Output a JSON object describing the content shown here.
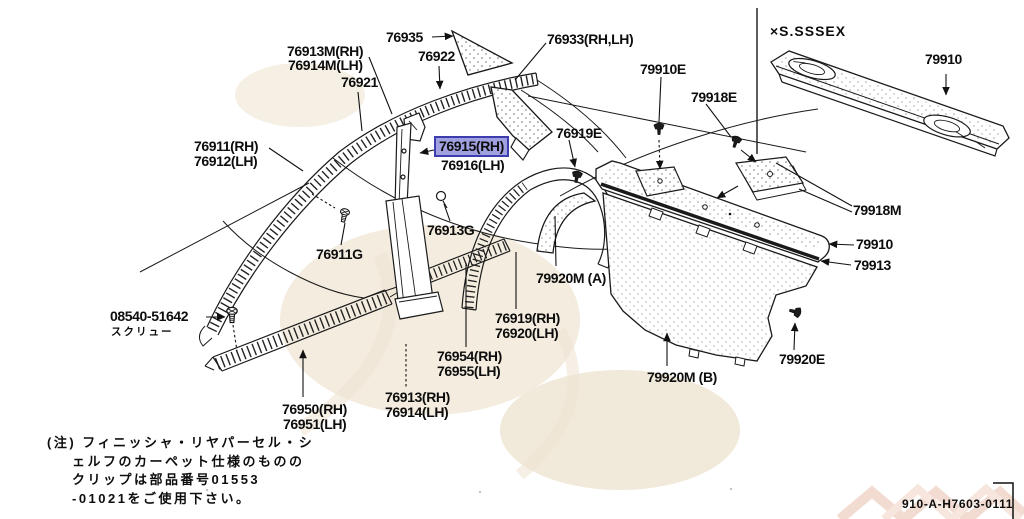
{
  "diagram": {
    "doc_number": "910-A-H7603-0111",
    "inset": {
      "variant": "×S.SSSEX",
      "part": "79910"
    },
    "note": {
      "lines": [
        "(注) フィニッシャ・リヤパーセル・シ",
        "ェルフのカーペット仕様のものの",
        "クリップは部品番号01553",
        "-01021をご使用下さい。"
      ]
    },
    "labels": {
      "l76935": "76935",
      "l76913M_rh": "76913M(RH)",
      "l76914M_lh": "76914M(LH)",
      "l76921": "76921",
      "l76922": "76922",
      "l76933": "76933(RH,LH)",
      "l79910E": "79910E",
      "l79918E": "79918E",
      "l76919E": "76919E",
      "l76911_rh": "76911(RH)",
      "l76912_lh": "76912(LH)",
      "l76915_rh": "76915(RH)",
      "l76916_lh": "76916(LH)",
      "l79918M": "79918M",
      "l79910": "79910",
      "l79913": "79913",
      "l76913G": "76913G",
      "l76911G": "76911G",
      "l79920MA": "79920M (A)",
      "l08540": "08540-51642",
      "l08540_sub": "スクリュー",
      "l76919_rh": "76919(RH)",
      "l76920_lh": "76920(LH)",
      "l76954_rh": "76954(RH)",
      "l76955_lh": "76955(LH)",
      "l76913_rh": "76913(RH)",
      "l76914_lh": "76914(LH)",
      "l76950_rh": "76950(RH)",
      "l76951_lh": "76951(LH)",
      "l79920MB": "79920M (B)",
      "l79920E": "79920E"
    }
  },
  "colors": {
    "highlight_fill": "rgba(130,130,215,0.75)",
    "highlight_border": "#3d3dae",
    "ink": "#111111",
    "background": "#ffffff"
  }
}
